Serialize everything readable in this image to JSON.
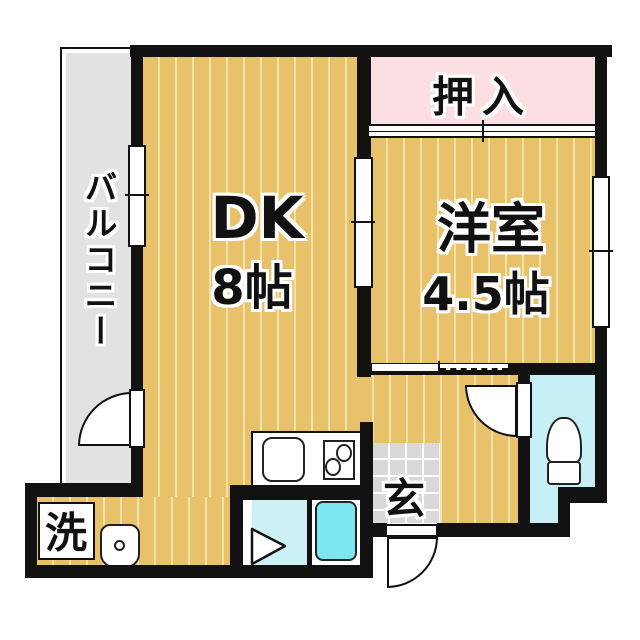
{
  "type": "floor-plan",
  "labels": {
    "balcony": "バルコニー",
    "dk_name": "DK",
    "dk_size": "8帖",
    "closet": "押入",
    "western_room": "洋室",
    "western_room_size": "4.5帖",
    "entrance": "玄",
    "laundry": "洗"
  },
  "icons": {
    "toilet": "toilet-icon",
    "bathtub": "bathtub-icon",
    "kitchen_sink": "kitchen-sink-icon",
    "stove": "stove-burners-icon",
    "washbasin": "washbasin-icon",
    "bathroom_door": "folding-door-icon",
    "swing_doors": "door-swing-arc-icon",
    "windows": "window-icon",
    "sliding_doors": "sliding-door-icon"
  },
  "colors": {
    "wall": "#111111",
    "floor": "#e8c26b",
    "floor_stripe": "#f6e1a9",
    "closet": "#fcdfe3",
    "balcony": "#e2e2e2",
    "tile": "#d9d9d9",
    "water": "#c6eff6",
    "bathtub": "#7ce7f0"
  }
}
